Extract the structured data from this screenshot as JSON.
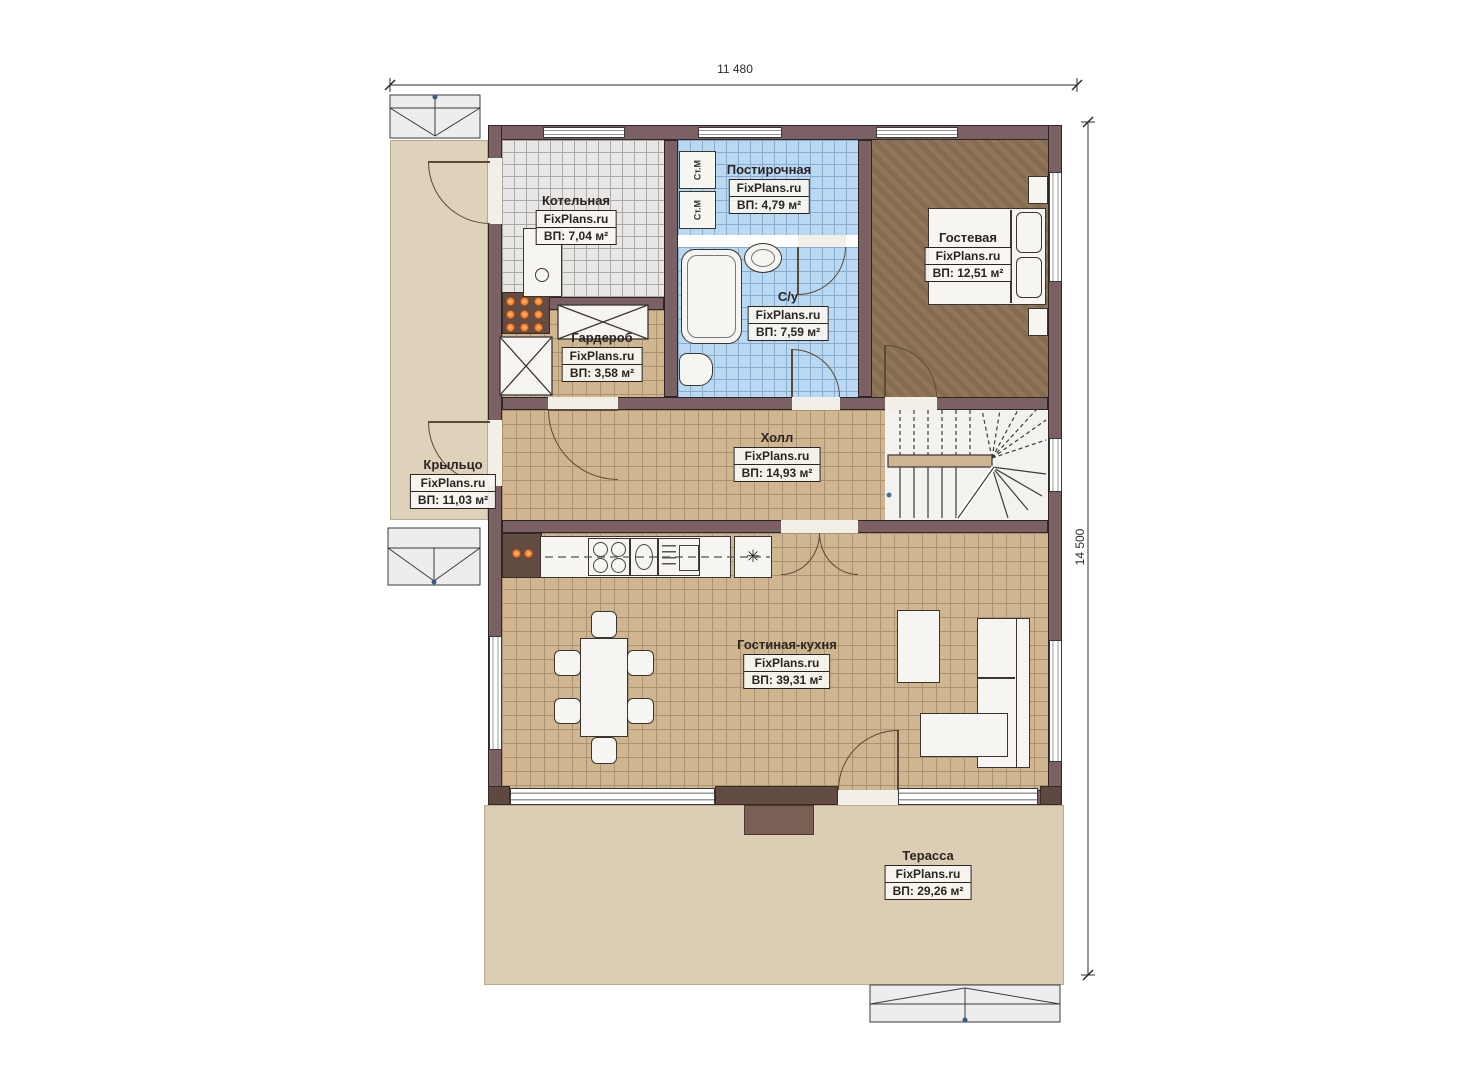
{
  "dimensions": {
    "width_label": "11 480",
    "height_label": "14 500"
  },
  "rooms": [
    {
      "name": "Котельная",
      "brand": "FixPlans.ru",
      "area": "ВП: 7,04 м²"
    },
    {
      "name": "Постирочная",
      "brand": "FixPlans.ru",
      "area": "ВП: 4,79 м²"
    },
    {
      "name": "Гостевая",
      "brand": "FixPlans.ru",
      "area": "ВП: 12,51 м²"
    },
    {
      "name": "С/у",
      "brand": "FixPlans.ru",
      "area": "ВП: 7,59 м²"
    },
    {
      "name": "Гардероб",
      "brand": "FixPlans.ru",
      "area": "ВП: 3,58 м²"
    },
    {
      "name": "Холл",
      "brand": "FixPlans.ru",
      "area": "ВП: 14,93 м²"
    },
    {
      "name": "Крыльцо",
      "brand": "FixPlans.ru",
      "area": "ВП: 11,03 м²"
    },
    {
      "name": "Гостиная-кухня",
      "brand": "FixPlans.ru",
      "area": "ВП: 39,31 м²"
    },
    {
      "name": "Терасса",
      "brand": "FixPlans.ru",
      "area": "ВП: 29,26 м²"
    }
  ],
  "appliances": {
    "washer_label": "Ст.М",
    "fridge_symbol": "✳"
  },
  "colors": {
    "wall": "#7c6164",
    "tile_blue": "#b9d8f1",
    "tile_tan": "#cfb590",
    "tile_gray": "#e8e7e5",
    "floor_brown": "#8c7254",
    "outdoor_beige": "#ded2ba",
    "radiator_orange": "#ff8c3a"
  }
}
